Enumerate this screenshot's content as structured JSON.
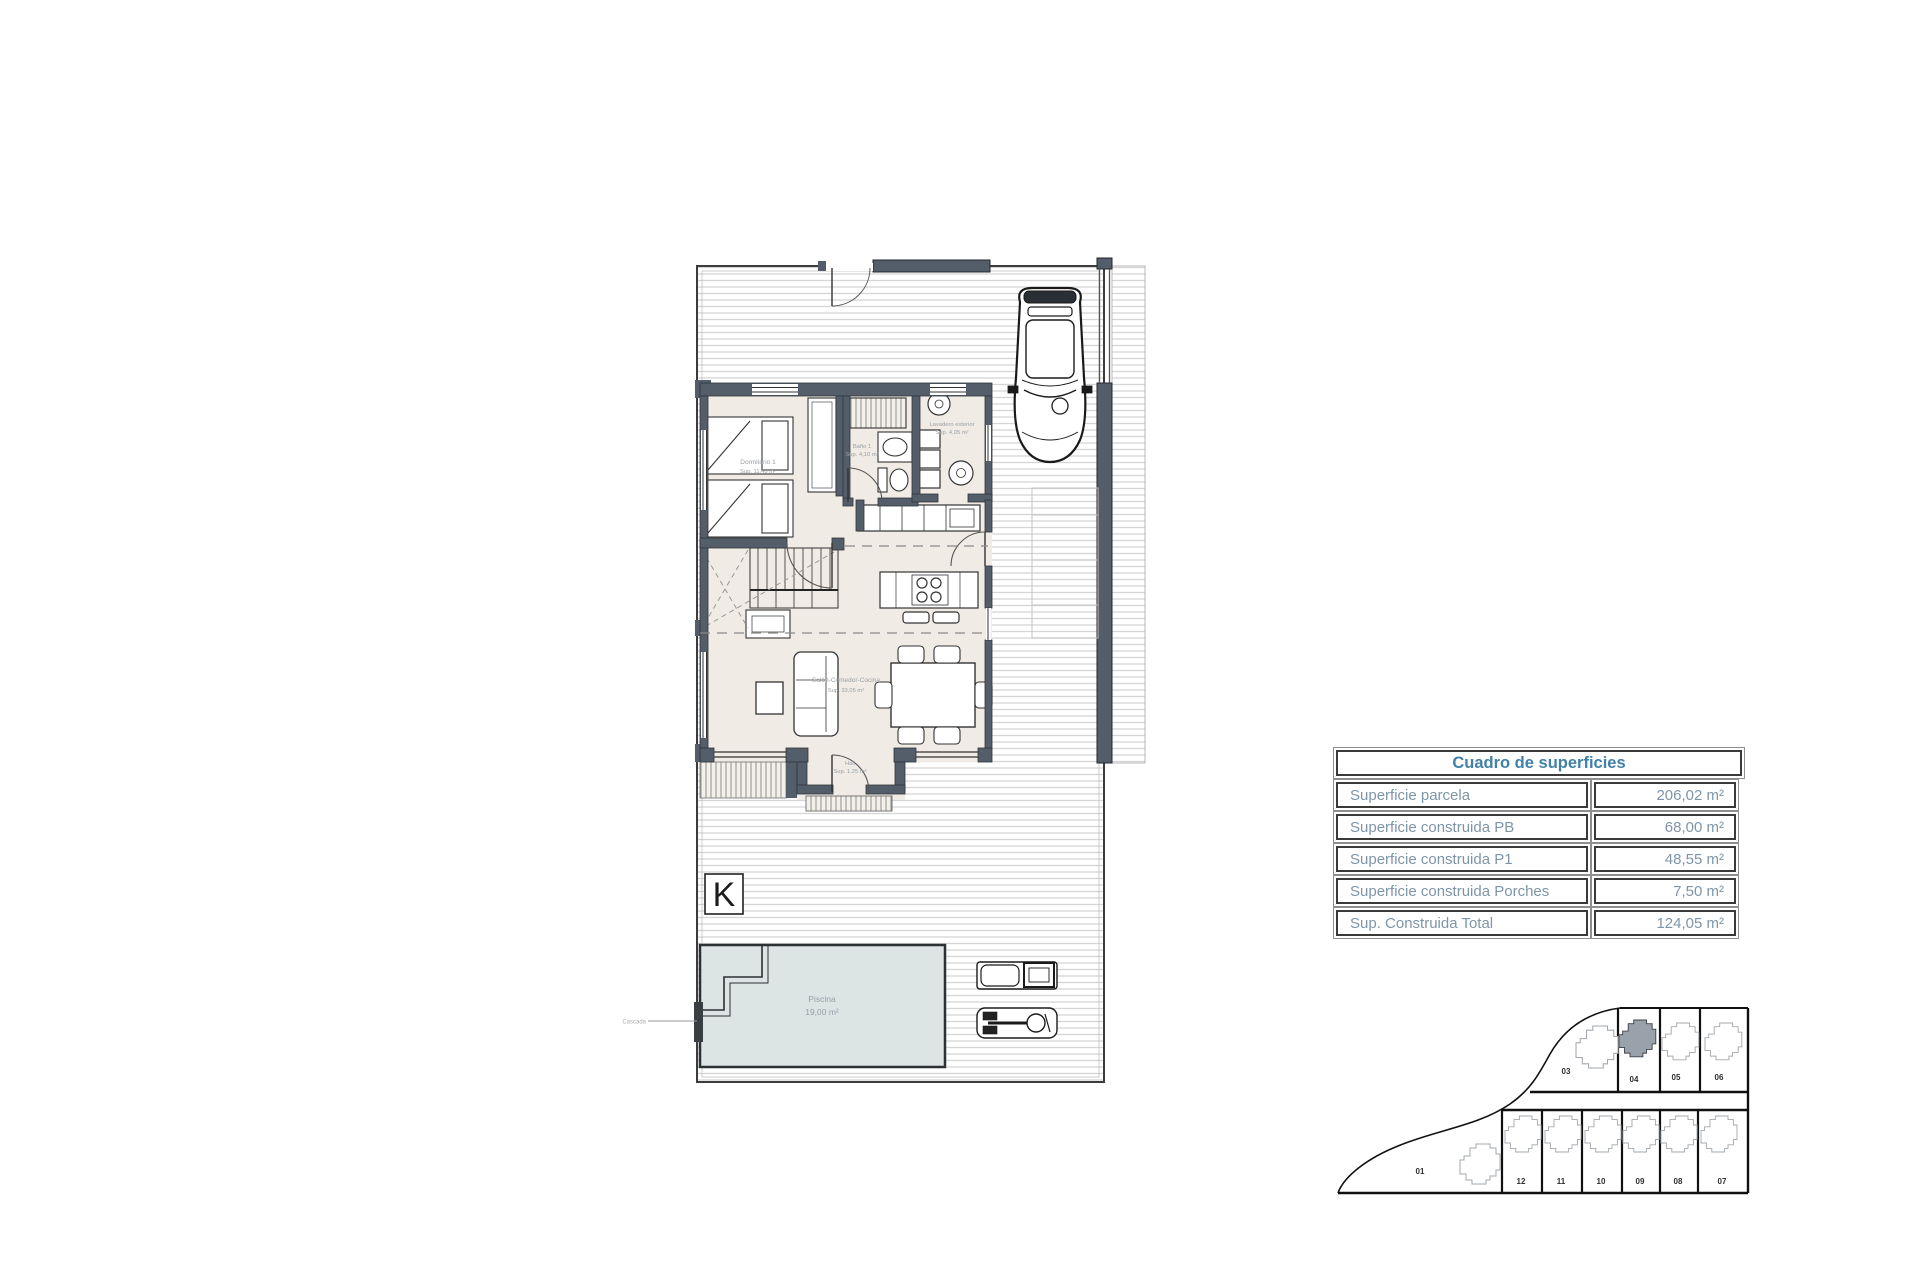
{
  "document": {
    "type": "architectural-floor-plan-sheet",
    "background": "#ffffff"
  },
  "surface_table": {
    "title": "Cuadro de superficies",
    "rows": [
      {
        "label": "Superficie parcela",
        "value": "206,02 m²"
      },
      {
        "label": "Superficie construida PB",
        "value": "68,00 m²"
      },
      {
        "label": "Superficie construida P1",
        "value": "48,55 m²"
      },
      {
        "label": "Superficie construida Porches",
        "value": "7,50 m²"
      },
      {
        "label": "Sup. Construida Total",
        "value": "124,05 m²"
      }
    ],
    "accent_color": "#4180a8",
    "body_text_color": "#7e95a8"
  },
  "floor_plan": {
    "compass_letter": "K",
    "labels": {
      "bedroom": [
        "Dormitorio 1",
        "Sup. 11,40 m²"
      ],
      "bathroom": [
        "Baño 1",
        "Sup. 4,10 m²"
      ],
      "laundry": [
        "Lavadero exterior",
        "Sup. 4,05 m²"
      ],
      "living": [
        "Salón-Comedor-Cocina",
        "Sup. 33,05 m²"
      ],
      "hall": [
        "Hall",
        "Sup. 1,25 m²"
      ],
      "pool": [
        "Piscina",
        "19,00 m²"
      ],
      "cascade": "Cascada"
    },
    "colors": {
      "wall": "#545e6a",
      "interior_floor": "#f1ebe5",
      "deck_hatch_line": "#d6d6d6",
      "pool_fill": "#dde4e4"
    }
  },
  "site_plan": {
    "big_plot": {
      "label": "01"
    },
    "plots_top": [
      {
        "label": "03",
        "highlighted": false
      },
      {
        "label": "04",
        "highlighted": true
      },
      {
        "label": "05",
        "highlighted": false
      },
      {
        "label": "06",
        "highlighted": false
      }
    ],
    "plots_bottom": [
      {
        "label": "12"
      },
      {
        "label": "11"
      },
      {
        "label": "10"
      },
      {
        "label": "09"
      },
      {
        "label": "08"
      },
      {
        "label": "07"
      }
    ],
    "highlight_color": "#99a1ab"
  }
}
